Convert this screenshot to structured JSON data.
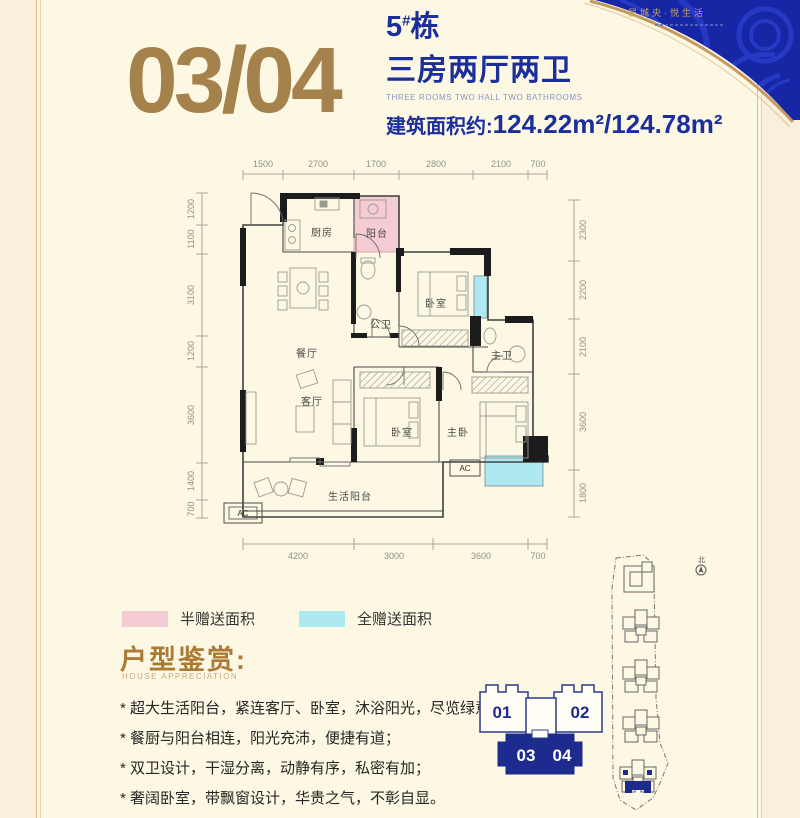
{
  "page": {
    "bg": "#fdf8e3",
    "margin_bg": "#faeedd",
    "frame_color": "#d9b98c"
  },
  "header": {
    "unit_numbers": "03/04",
    "building_no": "5",
    "building_hash": "#",
    "building_suffix": "栋",
    "title_cn": "三房两厅两卫",
    "title_en": "THREE ROOMS TWO HALL TWO BATHROOMS",
    "area_label": "建筑面积约:",
    "area_value": "124.22m²/124.78m²",
    "accent_color": "#a5814b",
    "blue_color": "#1b2e9a"
  },
  "decor": {
    "tagline": "居城央·悦生活"
  },
  "floorplan": {
    "dims_top": [
      "1500",
      "2700",
      "1700",
      "2800",
      "2100",
      "700"
    ],
    "dims_bottom": [
      "4200",
      "3000",
      "3600",
      "700"
    ],
    "dims_left": [
      "1200",
      "1100",
      "3100",
      "1200",
      "3600",
      "1400",
      "700"
    ],
    "dims_right": [
      "2300",
      "2200",
      "2100",
      "3600",
      "1800"
    ],
    "rooms": {
      "kitchen": "厨房",
      "balcony": "阳台",
      "public_bath": "公卫",
      "bedroom_a": "卧室",
      "dining": "餐厅",
      "master_bath": "主卫",
      "living": "客厅",
      "bedroom_b": "卧室",
      "master_bedroom": "主卧",
      "life_balcony": "生活阳台",
      "ac": "AC"
    },
    "colors": {
      "half_gift": "#f6ccd4",
      "full_gift": "#aee9f1"
    }
  },
  "legend": {
    "half_label": "半赠送面积",
    "full_label": "全赠送面积"
  },
  "appreciation": {
    "title": "户型鉴赏:",
    "subtitle": "HOUSE APPRECIATION",
    "points": [
      "* 超大生活阳台，紧连客厅、卧室，沐浴阳光，尽览绿意；",
      "* 餐厨与阳台相连，阳光充沛，便捷有道；",
      "* 双卫设计，干湿分离，动静有序，私密有加；",
      "* 奢阔卧室，带飘窗设计，华贵之气，不彰自显。"
    ]
  },
  "unit_diagram": {
    "unit_01": "01",
    "unit_02": "02",
    "unit_03": "03",
    "unit_04": "04",
    "highlight_color": "#1e2b8e"
  },
  "site_plan": {
    "north_label": "北"
  }
}
